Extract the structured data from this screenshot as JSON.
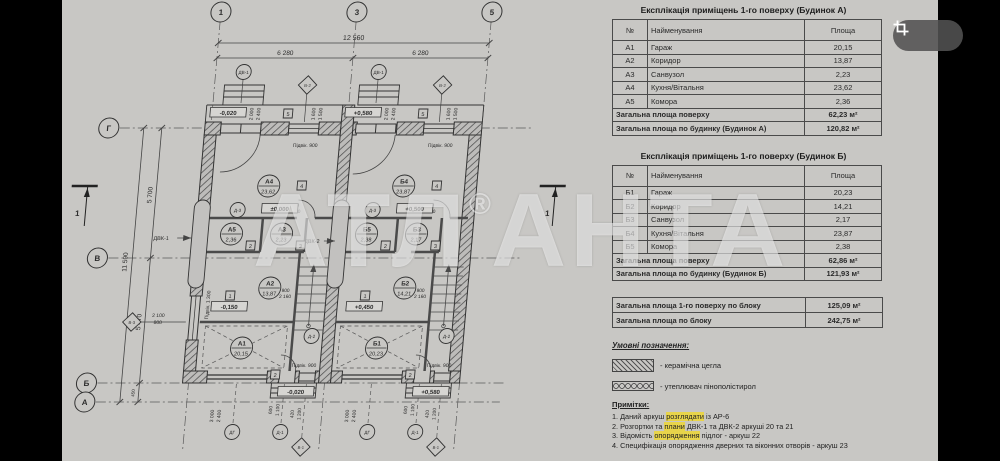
{
  "colors": {
    "highlight": "#e8d44a",
    "paper": "#c8c7c4",
    "line": "#3a3a3a",
    "watermark": "rgba(255,255,255,0.52)"
  },
  "viewer": {
    "crop_button": "crop-icon"
  },
  "watermark": {
    "part1": "АТЛ",
    "reg": "®",
    "part2": "АНТА"
  },
  "tables": {
    "house_a": {
      "title": "Експлікація приміщень 1-го поверху (Будинок А)",
      "columns": [
        "№",
        "Найменування",
        "Площа"
      ],
      "rows": [
        [
          "А1",
          "Гараж",
          "20,15"
        ],
        [
          "А2",
          "Коридор",
          "13,87"
        ],
        [
          "А3",
          "Санвузол",
          "2,23"
        ],
        [
          "А4",
          "Кухня/Вітальня",
          "23,62"
        ],
        [
          "А5",
          "Комора",
          "2,36"
        ]
      ],
      "totals": [
        [
          "Загальна площа поверху",
          "62,23 м²"
        ],
        [
          "Загальна площа по будинку (Будинок А)",
          "120,82 м²"
        ]
      ]
    },
    "house_b": {
      "title": "Експлікація приміщень 1-го поверху (Будинок Б)",
      "columns": [
        "№",
        "Найменування",
        "Площа"
      ],
      "rows": [
        [
          "Б1",
          "Гараж",
          "20,23"
        ],
        [
          "Б2",
          "Коридор",
          "14,21"
        ],
        [
          "Б3",
          "Санвузол",
          "2,17"
        ],
        [
          "Б4",
          "Кухня/Вітальня",
          "23,87"
        ],
        [
          "Б5",
          "Комора",
          "2,38"
        ]
      ],
      "totals": [
        [
          "Загальна площа поверху",
          "62,86 м²"
        ],
        [
          "Загальна площа по будинку (Будинок Б)",
          "121,93 м²"
        ]
      ]
    },
    "block": {
      "rows": [
        [
          "Загальна площа 1-го поверху по блоку",
          "125,09 м²"
        ],
        [
          "Загальна площа по блоку",
          "242,75 м²"
        ]
      ]
    }
  },
  "legend": {
    "title": "Умовні позначення:",
    "items": [
      {
        "swatch": "brick-hatch",
        "label": "- керамічна цегла"
      },
      {
        "swatch": "insulation-hatch",
        "label": "- утеплювач пінополістирол"
      }
    ]
  },
  "notes": {
    "title": "Примітки:",
    "items": [
      {
        "pre": "1. Даний аркуш ",
        "hl": "розглядати",
        "post": " із АР-6"
      },
      {
        "pre": "2. Розгортки та ",
        "hl": "плани",
        "post": " ДВК-1 та ДВК-2 аркуші 20 та 21"
      },
      {
        "pre": "3. Відомість ",
        "hl": "опорядження",
        "post": " підлог - аркуш 22"
      },
      {
        "pre": "4. Специфікація опорядження дверних та віконних отворів - аркуш 23",
        "hl": "",
        "post": ""
      }
    ]
  },
  "plan": {
    "axis_top": [
      {
        "x": 222,
        "label": "1"
      },
      {
        "x": 358,
        "label": "3"
      },
      {
        "x": 493,
        "label": "5"
      }
    ],
    "axis_left": [
      {
        "y": 128,
        "label": "Г"
      },
      {
        "y": 258,
        "label": "В"
      },
      {
        "y": 383,
        "label": "Б"
      },
      {
        "y": 402,
        "label": "А"
      }
    ],
    "texts": [
      {
        "t": "12 560",
        "x": 357,
        "y": 40,
        "s": 7
      },
      {
        "t": "6 280",
        "x": 290,
        "y": 55,
        "s": 6.5
      },
      {
        "t": "6 280",
        "x": 425,
        "y": 55,
        "s": 6.5
      },
      {
        "t": "11 590",
        "x": 150,
        "y": 262,
        "r": -90,
        "s": 6.5
      },
      {
        "t": "5 700",
        "x": 169,
        "y": 195,
        "r": -90,
        "s": 6.5
      },
      {
        "t": "5 470",
        "x": 169,
        "y": 322,
        "r": -90,
        "s": 6.5
      },
      {
        "t": "450",
        "x": 169,
        "y": 393,
        "r": -90,
        "s": 4.5
      },
      {
        "t": "2 000",
        "x": 263,
        "y": 114,
        "r": -90,
        "s": 5
      },
      {
        "t": "2 400",
        "x": 270,
        "y": 114,
        "r": -90,
        "s": 5
      },
      {
        "t": "1 600",
        "x": 325,
        "y": 114,
        "r": -90,
        "s": 5
      },
      {
        "t": "1 500",
        "x": 332,
        "y": 114,
        "r": -90,
        "s": 5
      },
      {
        "t": "2 000",
        "x": 398,
        "y": 114,
        "r": -90,
        "s": 5
      },
      {
        "t": "2 400",
        "x": 405,
        "y": 114,
        "r": -90,
        "s": 5
      },
      {
        "t": "1 600",
        "x": 460,
        "y": 114,
        "r": -90,
        "s": 5
      },
      {
        "t": "1 500",
        "x": 467,
        "y": 114,
        "r": -90,
        "s": 5
      },
      {
        "t": "Підвік. 900",
        "x": 318,
        "y": 147,
        "s": 5
      },
      {
        "t": "Підвік. 900",
        "x": 453,
        "y": 147,
        "s": 5
      },
      {
        "t": "Підвік. 900",
        "x": 336,
        "y": 367,
        "s": 5
      },
      {
        "t": "Підвік. 900",
        "x": 471,
        "y": 367,
        "s": 5
      },
      {
        "t": "Підвік. 1 300",
        "x": 236,
        "y": 305,
        "r": -90,
        "s": 5
      },
      {
        "t": "2 100",
        "x": 186,
        "y": 317,
        "s": 5
      },
      {
        "t": "800",
        "x": 186,
        "y": 324,
        "s": 5
      },
      {
        "t": "800",
        "x": 313,
        "y": 207,
        "s": 4.8
      },
      {
        "t": "2 100",
        "x": 313,
        "y": 213,
        "s": 4.8
      },
      {
        "t": "800",
        "x": 448,
        "y": 207,
        "s": 4.8
      },
      {
        "t": "2 100",
        "x": 448,
        "y": 213,
        "s": 4.8
      },
      {
        "t": "900",
        "x": 311,
        "y": 292,
        "s": 4.8
      },
      {
        "t": "2 160",
        "x": 311,
        "y": 298,
        "s": 4.8
      },
      {
        "t": "900",
        "x": 446,
        "y": 292,
        "s": 4.8
      },
      {
        "t": "2 160",
        "x": 446,
        "y": 298,
        "s": 4.8
      },
      {
        "t": "3 000",
        "x": 250,
        "y": 416,
        "r": -90,
        "s": 5
      },
      {
        "t": "2 400",
        "x": 257,
        "y": 416,
        "r": -90,
        "s": 5
      },
      {
        "t": "3 000",
        "x": 385,
        "y": 416,
        "r": -90,
        "s": 5
      },
      {
        "t": "2 400",
        "x": 392,
        "y": 416,
        "r": -90,
        "s": 5
      },
      {
        "t": "600",
        "x": 308,
        "y": 410,
        "r": -90,
        "s": 4.8
      },
      {
        "t": "1 100",
        "x": 315,
        "y": 410,
        "r": -90,
        "s": 4.8
      },
      {
        "t": "420",
        "x": 330,
        "y": 414,
        "r": -90,
        "s": 4.8
      },
      {
        "t": "1 200",
        "x": 337,
        "y": 414,
        "r": -90,
        "s": 4.8
      },
      {
        "t": "600",
        "x": 443,
        "y": 410,
        "r": -90,
        "s": 4.8
      },
      {
        "t": "1 100",
        "x": 450,
        "y": 410,
        "r": -90,
        "s": 4.8
      },
      {
        "t": "420",
        "x": 465,
        "y": 414,
        "r": -90,
        "s": 4.8
      },
      {
        "t": "1 200",
        "x": 472,
        "y": 414,
        "r": -90,
        "s": 4.8
      },
      {
        "t": "ДВК-1",
        "x": 182,
        "y": 240,
        "s": 5.5
      },
      {
        "t": "ДВК-2",
        "x": 333,
        "y": 243,
        "s": 5.5
      },
      {
        "t": "1",
        "x": 96,
        "y": 216,
        "s": 8,
        "b": 1
      },
      {
        "t": "1",
        "x": 566,
        "y": 216,
        "s": 8,
        "b": 1
      }
    ],
    "room_tags": [
      {
        "x": 285,
        "y": 186,
        "a": "А4",
        "b": "23,62"
      },
      {
        "x": 420,
        "y": 186,
        "a": "Б4",
        "b": "23,87"
      },
      {
        "x": 252,
        "y": 234,
        "a": "А5",
        "b": "2,36"
      },
      {
        "x": 302,
        "y": 234,
        "a": "А3",
        "b": "2,23"
      },
      {
        "x": 387,
        "y": 234,
        "a": "Б5",
        "b": "2,38"
      },
      {
        "x": 437,
        "y": 234,
        "a": "Б3",
        "b": "2,17"
      },
      {
        "x": 295,
        "y": 288,
        "a": "А2",
        "b": "13,87"
      },
      {
        "x": 430,
        "y": 288,
        "a": "Б2",
        "b": "14,21"
      },
      {
        "x": 272,
        "y": 348,
        "a": "А1",
        "b": "20,15"
      },
      {
        "x": 407,
        "y": 348,
        "a": "Б1",
        "b": "20,23"
      }
    ],
    "mark_circles": [
      {
        "x": 250,
        "y": 72,
        "t": "ДВ-1"
      },
      {
        "x": 385,
        "y": 72,
        "t": "ДВ-1"
      },
      {
        "x": 256,
        "y": 210,
        "t": "Д-3"
      },
      {
        "x": 391,
        "y": 210,
        "t": "Д-3"
      },
      {
        "x": 341,
        "y": 336,
        "t": "Д-2"
      },
      {
        "x": 476,
        "y": 336,
        "t": "Д-2"
      },
      {
        "x": 270,
        "y": 432,
        "t": "ДГ"
      },
      {
        "x": 405,
        "y": 432,
        "t": "ДГ"
      },
      {
        "x": 318,
        "y": 432,
        "t": "Д-1"
      },
      {
        "x": 453,
        "y": 432,
        "t": "Д-1"
      }
    ],
    "diamonds": [
      {
        "x": 315,
        "y": 85,
        "t": "В-2"
      },
      {
        "x": 450,
        "y": 85,
        "t": "В-2"
      },
      {
        "x": 160,
        "y": 322,
        "t": "В-3"
      },
      {
        "x": 340,
        "y": 447,
        "t": "В-1"
      },
      {
        "x": 475,
        "y": 447,
        "t": "В-1"
      }
    ],
    "squares": [
      {
        "x": 298,
        "y": 114,
        "t": "5"
      },
      {
        "x": 433,
        "y": 114,
        "t": "5"
      },
      {
        "x": 318,
        "y": 186,
        "t": "4"
      },
      {
        "x": 453,
        "y": 186,
        "t": "4"
      },
      {
        "x": 272,
        "y": 246,
        "t": "2"
      },
      {
        "x": 407,
        "y": 246,
        "t": "2"
      },
      {
        "x": 322,
        "y": 246,
        "t": "3"
      },
      {
        "x": 457,
        "y": 246,
        "t": "3"
      },
      {
        "x": 256,
        "y": 296,
        "t": "1"
      },
      {
        "x": 391,
        "y": 296,
        "t": "1"
      },
      {
        "x": 308,
        "y": 375,
        "t": "2"
      },
      {
        "x": 443,
        "y": 375,
        "t": "2"
      }
    ],
    "elevations": [
      {
        "x": 238,
        "y": 114,
        "t": "-0,020"
      },
      {
        "x": 373,
        "y": 114,
        "t": "+0,580"
      },
      {
        "x": 298,
        "y": 210,
        "t": "±0,000"
      },
      {
        "x": 433,
        "y": 210,
        "t": "+0,500"
      },
      {
        "x": 256,
        "y": 308,
        "t": "-0,150"
      },
      {
        "x": 391,
        "y": 308,
        "t": "+0,450"
      },
      {
        "x": 330,
        "y": 393,
        "t": "-0,020"
      },
      {
        "x": 465,
        "y": 393,
        "t": "+0,580"
      }
    ]
  }
}
